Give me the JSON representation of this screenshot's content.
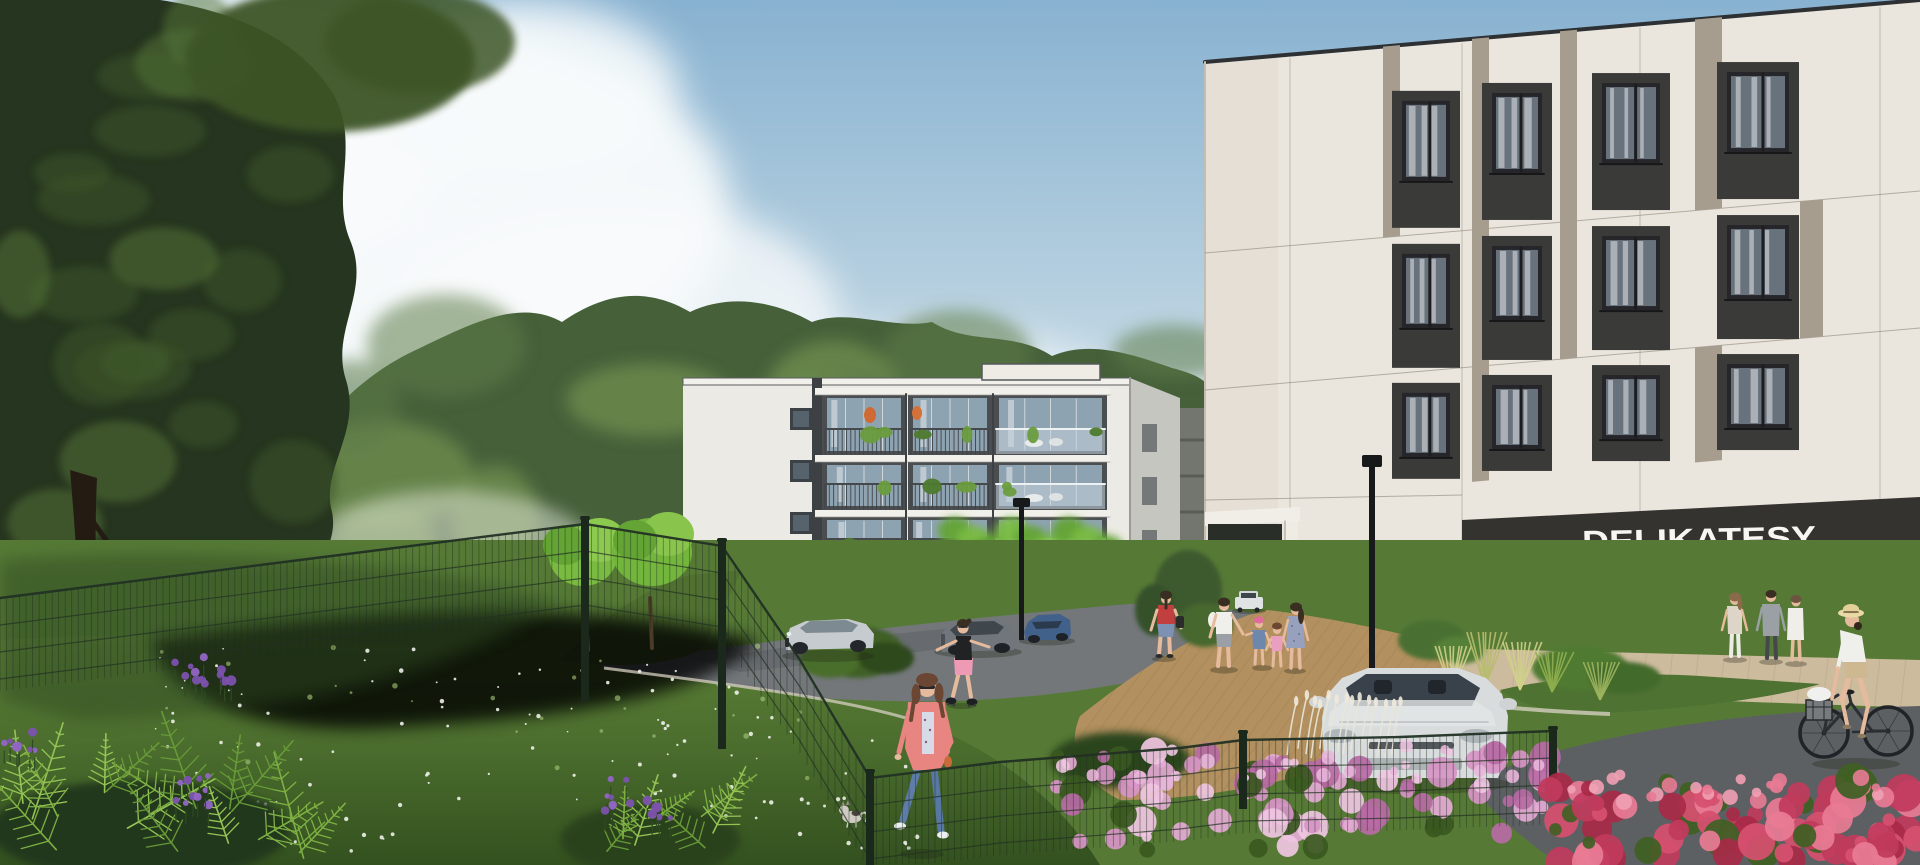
{
  "scene_description": "Photorealistic architectural rendering of a residential estate: two modern apartment buildings, a DELIKATESY grocery storefront, lawns, mesh fence, flowers, pedestrians, a rollerblader, a cyclist and parked cars on a sunny day",
  "signage": {
    "delikatesy": "DELIKATESY"
  },
  "colors": {
    "sky_top": "#88b2d1",
    "sky_mid": "#b5cfdf",
    "sky_low": "#dce8ee",
    "cloud": "#f7fafb",
    "forest_dark": "#46603a",
    "forest_mid": "#5d7c49",
    "forest_light": "#7fa058",
    "haze": "#e8ecdf",
    "tree_dark": "#26351f",
    "tree_mid": "#3d5527",
    "tree_light": "#567538",
    "tree_trim_bright": "#79bb41",
    "tree_trim_light": "#8cc94f",
    "tree_trim_deep": "#63a434",
    "birch": "#cdd0c6",
    "facade_white": "#eceae4",
    "facade_slab": "#f2f0ea",
    "facade_dark": "#3e4144",
    "balcony_back": "#4b4e51",
    "balcony_glass": "#8ea3b2",
    "side_gray": "#c6c6c1",
    "cream": "#ebe6dd",
    "taupe": "#a69d8f",
    "seam": "#8b857a",
    "charcoal": "#3a3a38",
    "window_frame": "#26262a",
    "window_glass": "#68727c",
    "curtain": "#d8dbde",
    "store_band": "#34332f",
    "sign_text": "#f7f6f3",
    "store_wall": "#e4decf",
    "wood_door": "#b9894f",
    "distant_bldg": "#72766e",
    "asphalt": "#73777a",
    "asphalt_dark": "#5c6063",
    "plaza_brick": "#b3905f",
    "sidewalk": "#cdbb9e",
    "path_dark": "#5d6062",
    "curb": "#d6cfc0",
    "lawn": "#567a36",
    "lawn_light": "#7da64b",
    "lawn_dark": "#2f4a22",
    "fence_dark": "#1b291d",
    "fence_wire": "#223024",
    "azalea_pink": "#d795c5",
    "azalea_light": "#f0c6e2",
    "azalea_deep": "#b76aa4",
    "flower_red": "#d6506f",
    "flower_red_deep": "#a82a48",
    "flower_red_light": "#e87b95",
    "flower_purple": "#7c52ad",
    "fern_green": "#7fb043",
    "fern_light": "#95c455",
    "fern_deep": "#689a37",
    "grass_plume": "#e9e5d6",
    "grass_yellow": "#cfd08a",
    "car_silver": "#c6cbcf",
    "car_gray": "#70767c",
    "car_blue": "#41608a",
    "car_white": "#d8dcdd",
    "car_dark": "#2b2f33",
    "skin": "#e6bb9d",
    "hair_dark": "#3a2d22",
    "hair_brown": "#6b4733",
    "coral_jacket": "#e98580",
    "jeans_blue": "#5877a3",
    "cloth_white": "#efefec",
    "cloth_pink": "#ea9ec0",
    "cloth_red": "#c13f3f",
    "cloth_black": "#202224",
    "cloth_denim": "#6e87ad",
    "cloth_gray": "#9aa0a4",
    "cloth_beige": "#ddd6c8",
    "straw_hat": "#e9d9a4",
    "shorts_beige": "#cdb892",
    "shadow": "#1d2415"
  }
}
